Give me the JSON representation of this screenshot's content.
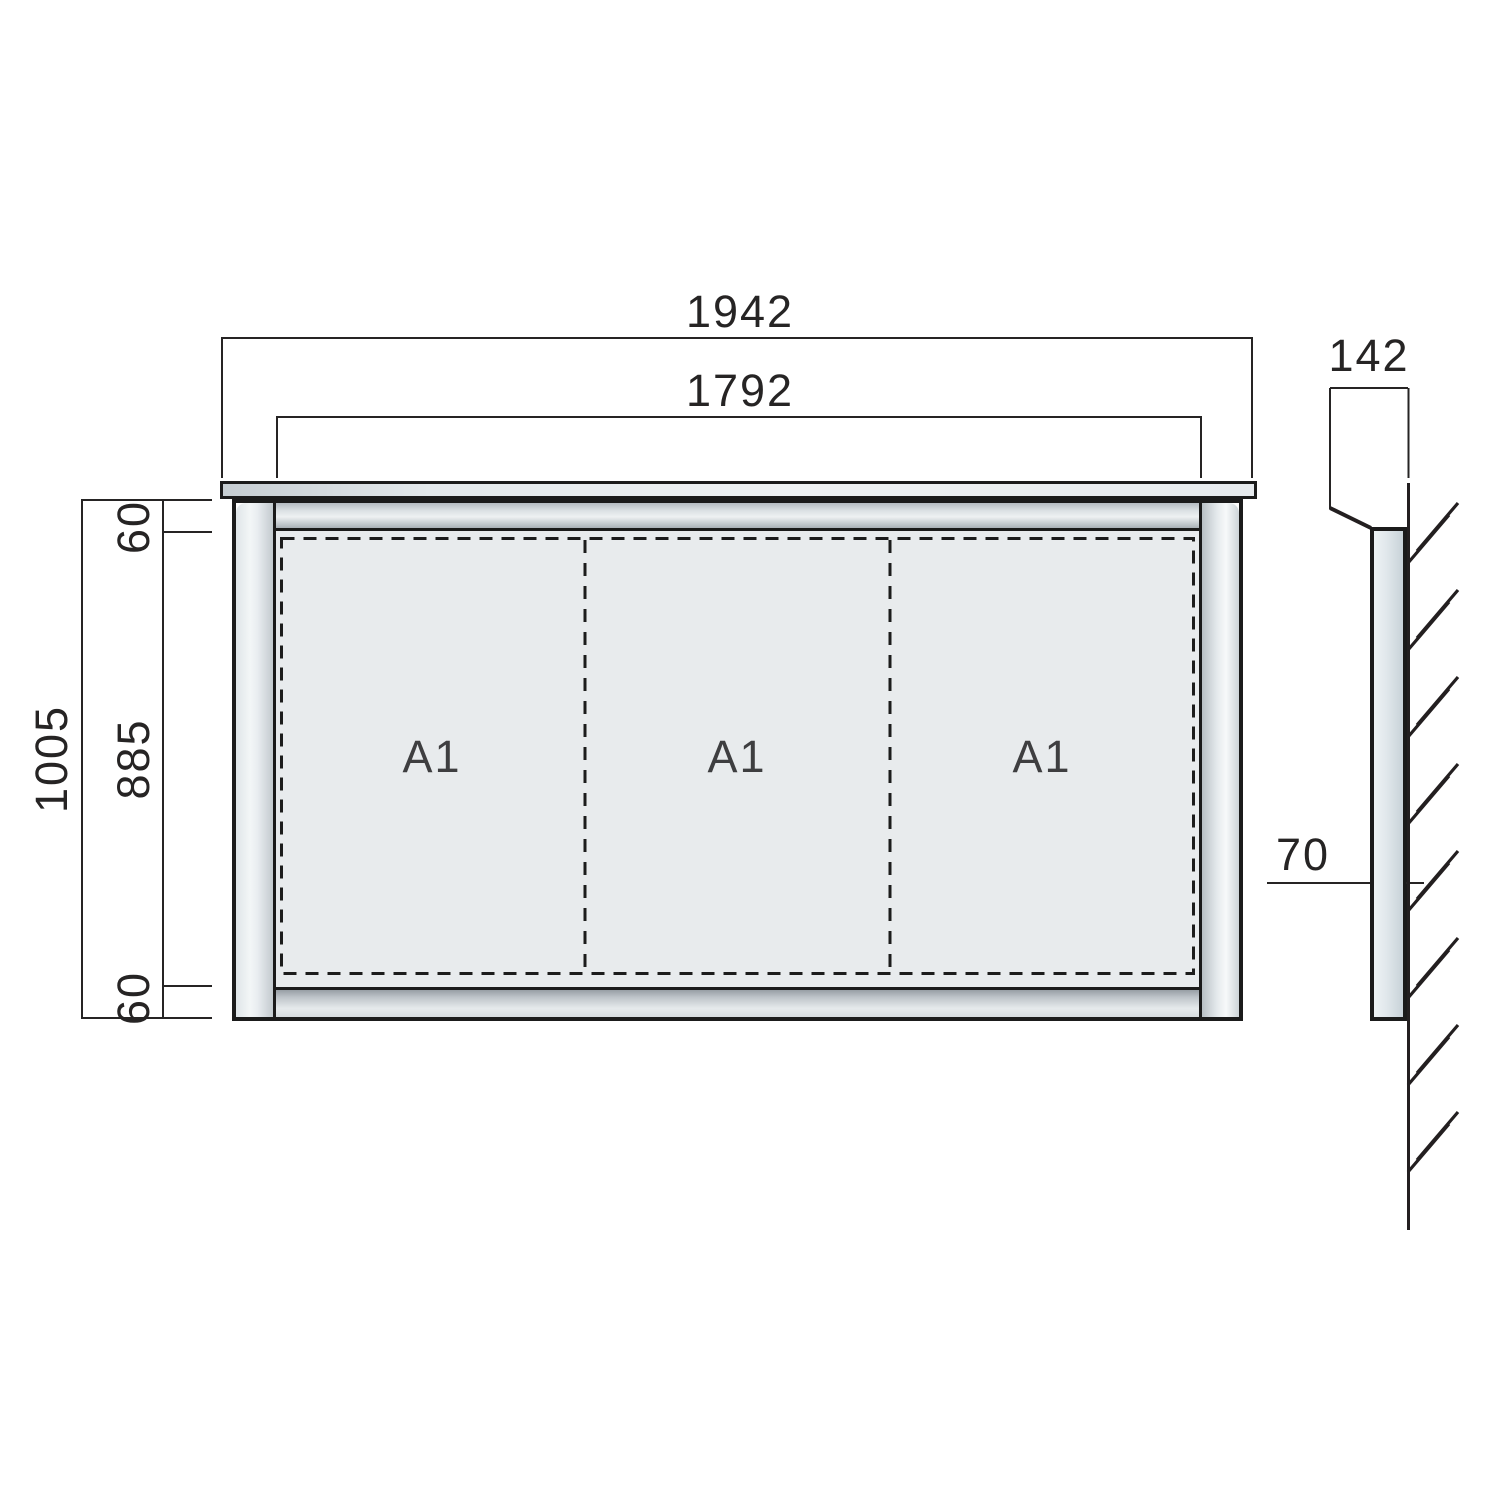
{
  "drawing_type": "wall-mounted sign board dimensional drawing",
  "front_view": {
    "dim_width_total": "1942",
    "dim_width_opening": "1792",
    "dim_height_total": "1005",
    "dim_margin_top": "60",
    "dim_height_opening": "885",
    "dim_margin_bottom": "60",
    "panels": [
      {
        "label": "A1"
      },
      {
        "label": "A1"
      },
      {
        "label": "A1"
      }
    ]
  },
  "side_view": {
    "dim_depth_total": "142",
    "dim_depth_body": "70"
  },
  "colors": {
    "line": "#231f20",
    "panel_fill": "#e8ebed",
    "frame_light": "#f5f7f8",
    "frame_mid": "#cdd4d8",
    "frame_dark": "#9aa1a7",
    "label_text": "#3e3e40",
    "background": "#ffffff"
  }
}
